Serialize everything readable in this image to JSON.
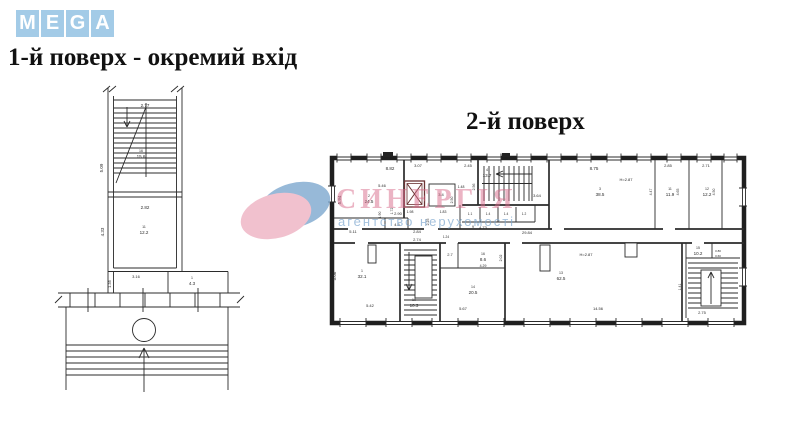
{
  "logo": {
    "letters": [
      "M",
      "E",
      "G",
      "A"
    ]
  },
  "headings": {
    "floor1": "1-й поверх - окремий вхід",
    "floor2": "2-й поверх"
  },
  "watermark": {
    "title": "СИНЕРГІЯ",
    "subtitle": "агентство нерухомості"
  },
  "colors": {
    "logo_tile": "#a3cbe7",
    "watermark_pink": "#d96c8b",
    "watermark_blue": "#7ea8cf",
    "elevator_red": "#6b3434",
    "ink": "#2b2b2b"
  },
  "plan1": {
    "labels": [
      {
        "t": "2.77",
        "x": 145,
        "y": 107,
        "s": 4.5
      },
      {
        "t": "5.09",
        "x": 103,
        "y": 168,
        "r": -90,
        "s": 4.5
      },
      {
        "t": "16",
        "x": 141,
        "y": 152,
        "s": 3.5
      },
      {
        "t": "15.6",
        "x": 141,
        "y": 158,
        "s": 4.5
      },
      {
        "t": "2.82",
        "x": 145,
        "y": 209,
        "s": 4.5
      },
      {
        "t": "4.33",
        "x": 104,
        "y": 232,
        "r": -90,
        "s": 4.5
      },
      {
        "t": "11",
        "x": 144,
        "y": 228,
        "s": 3.5
      },
      {
        "t": "12.2",
        "x": 144,
        "y": 234,
        "s": 4.5
      },
      {
        "t": "3.16",
        "x": 136,
        "y": 278,
        "s": 4
      },
      {
        "t": "1.35",
        "x": 111,
        "y": 284,
        "r": -90,
        "s": 4
      },
      {
        "t": "1",
        "x": 192,
        "y": 279,
        "s": 3.5
      },
      {
        "t": "4.3",
        "x": 192,
        "y": 285,
        "s": 4.5
      }
    ]
  },
  "plan2": {
    "labels": [
      {
        "t": "8.82",
        "x": 390,
        "y": 170,
        "s": 4.5
      },
      {
        "t": "5.94",
        "x": 341,
        "y": 200,
        "r": -90,
        "s": 4.5
      },
      {
        "t": "5.46",
        "x": 382,
        "y": 187,
        "s": 4
      },
      {
        "t": "2",
        "x": 369,
        "y": 197,
        "s": 3.5
      },
      {
        "t": "24.5",
        "x": 369,
        "y": 203,
        "s": 4.5
      },
      {
        "t": "2.90",
        "x": 398,
        "y": 215,
        "s": 4
      },
      {
        "t": "1.90",
        "x": 381,
        "y": 215,
        "r": -90,
        "s": 3.5
      },
      {
        "t": "1.72",
        "x": 393,
        "y": 211,
        "r": -90,
        "s": 3.5
      },
      {
        "t": "5.11",
        "x": 353,
        "y": 233,
        "s": 4
      },
      {
        "t": "4.5",
        "x": 397,
        "y": 226,
        "s": 4
      },
      {
        "t": "2.84",
        "x": 417,
        "y": 233,
        "s": 4
      },
      {
        "t": "2.25",
        "x": 429,
        "y": 222,
        "r": -90,
        "s": 3.5
      },
      {
        "t": "3.07",
        "x": 418,
        "y": 167,
        "s": 4
      },
      {
        "t": "2.45",
        "x": 468,
        "y": 167,
        "s": 4
      },
      {
        "t": "1.98",
        "x": 410,
        "y": 213,
        "s": 3.5
      },
      {
        "t": "1.83",
        "x": 443,
        "y": 213,
        "s": 3.5
      },
      {
        "t": "1.48",
        "x": 461,
        "y": 188,
        "s": 3.5
      },
      {
        "t": "2.50",
        "x": 453,
        "y": 200,
        "r": -90,
        "s": 3.5
      },
      {
        "t": "3.4",
        "x": 441,
        "y": 196,
        "s": 4,
        "c": "#b03434"
      },
      {
        "t": "4",
        "x": 487,
        "y": 171,
        "s": 3.5
      },
      {
        "t": "13.7",
        "x": 487,
        "y": 177,
        "s": 4.5
      },
      {
        "t": "2.56",
        "x": 475,
        "y": 187,
        "r": -90,
        "s": 3.5
      },
      {
        "t": "3.64",
        "x": 537,
        "y": 197,
        "s": 4
      },
      {
        "t": "1.1",
        "x": 470,
        "y": 215,
        "s": 3.2
      },
      {
        "t": "1.4",
        "x": 488,
        "y": 215,
        "s": 3.2
      },
      {
        "t": "1.4",
        "x": 506,
        "y": 215,
        "s": 3.2
      },
      {
        "t": "1.2",
        "x": 524,
        "y": 215,
        "s": 3.2
      },
      {
        "t": "9",
        "x": 473,
        "y": 228,
        "s": 3.5
      },
      {
        "t": "4.73",
        "x": 483,
        "y": 229,
        "s": 4
      },
      {
        "t": "29.84",
        "x": 527,
        "y": 234,
        "s": 4
      },
      {
        "t": "8.75",
        "x": 594,
        "y": 170,
        "s": 4.5
      },
      {
        "t": "3",
        "x": 600,
        "y": 190,
        "s": 3.5
      },
      {
        "t": "38.5",
        "x": 600,
        "y": 196,
        "s": 4.5
      },
      {
        "t": "H=2.87",
        "x": 626,
        "y": 181,
        "s": 4
      },
      {
        "t": "2.85",
        "x": 668,
        "y": 167,
        "s": 4
      },
      {
        "t": "4.47",
        "x": 652,
        "y": 192,
        "r": -90,
        "s": 3.5
      },
      {
        "t": "11",
        "x": 670,
        "y": 190,
        "s": 3.5
      },
      {
        "t": "11.9",
        "x": 670,
        "y": 196,
        "s": 4.5
      },
      {
        "t": "4.65",
        "x": 679,
        "y": 192,
        "r": -90,
        "s": 3.5
      },
      {
        "t": "2.71",
        "x": 706,
        "y": 167,
        "s": 4
      },
      {
        "t": "12",
        "x": 707,
        "y": 190,
        "s": 3.5
      },
      {
        "t": "12.2",
        "x": 707,
        "y": 196,
        "s": 4.5
      },
      {
        "t": "4.50",
        "x": 715,
        "y": 192,
        "r": -90,
        "s": 3.5
      },
      {
        "t": "1",
        "x": 362,
        "y": 272,
        "s": 3.5
      },
      {
        "t": "32.1",
        "x": 362,
        "y": 278,
        "s": 4.5
      },
      {
        "t": "5.06",
        "x": 336,
        "y": 276,
        "r": -90,
        "s": 4.5
      },
      {
        "t": "5.42",
        "x": 370,
        "y": 307,
        "s": 4
      },
      {
        "t": "2.74",
        "x": 417,
        "y": 241,
        "s": 4
      },
      {
        "t": "10",
        "x": 414,
        "y": 301,
        "s": 3.5
      },
      {
        "t": "10.3",
        "x": 414,
        "y": 307,
        "s": 4.5
      },
      {
        "t": "1.24",
        "x": 446,
        "y": 238,
        "s": 3.2
      },
      {
        "t": "2.7",
        "x": 450,
        "y": 256,
        "s": 4
      },
      {
        "t": "16",
        "x": 483,
        "y": 255,
        "s": 3.5
      },
      {
        "t": "8.6",
        "x": 483,
        "y": 261,
        "s": 4.5
      },
      {
        "t": "4.29",
        "x": 483,
        "y": 267,
        "s": 3.5
      },
      {
        "t": "2.02",
        "x": 502,
        "y": 258,
        "r": -90,
        "s": 3.5
      },
      {
        "t": "14",
        "x": 473,
        "y": 288,
        "s": 3.5
      },
      {
        "t": "20.5",
        "x": 473,
        "y": 294,
        "s": 4.5
      },
      {
        "t": "5.67",
        "x": 463,
        "y": 310,
        "s": 4
      },
      {
        "t": "13",
        "x": 561,
        "y": 274,
        "s": 3.5
      },
      {
        "t": "62.5",
        "x": 561,
        "y": 280,
        "s": 4.5
      },
      {
        "t": "H=2.87",
        "x": 586,
        "y": 256,
        "s": 4
      },
      {
        "t": "14.56",
        "x": 598,
        "y": 310,
        "s": 4
      },
      {
        "t": "15",
        "x": 698,
        "y": 249,
        "s": 3.5
      },
      {
        "t": "10.2",
        "x": 698,
        "y": 255,
        "s": 4.5
      },
      {
        "t": "2.75",
        "x": 702,
        "y": 314,
        "s": 4
      },
      {
        "t": "1.41",
        "x": 681,
        "y": 287,
        "r": -90,
        "s": 3.5
      },
      {
        "t": "0.80",
        "x": 718,
        "y": 252,
        "s": 3
      },
      {
        "t": "0.60",
        "x": 718,
        "y": 257,
        "s": 3
      }
    ]
  }
}
